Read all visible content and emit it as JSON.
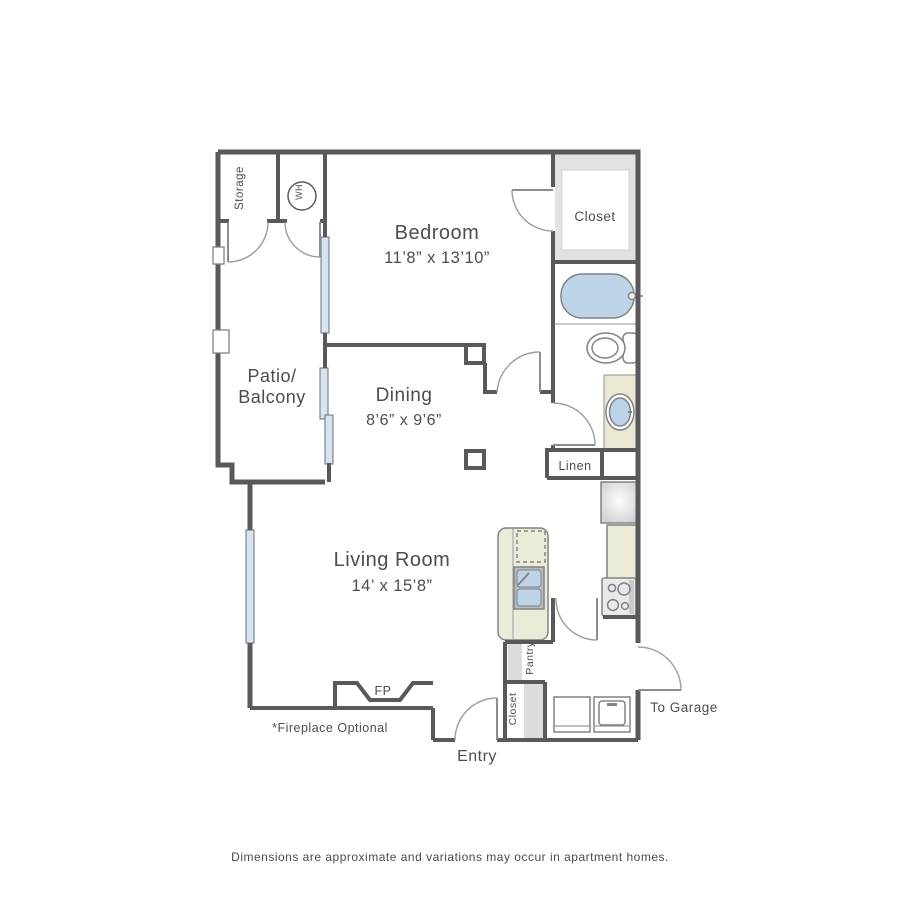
{
  "plan": {
    "rooms": {
      "storage": {
        "label": "Storage"
      },
      "water_heater": {
        "label": "WH"
      },
      "bedroom": {
        "label": "Bedroom",
        "dims": "11’8” x 13’10”"
      },
      "bedroom_closet": {
        "label": "Closet"
      },
      "patio": {
        "label_line1": "Patio/",
        "label_line2": "Balcony"
      },
      "dining": {
        "label": "Dining",
        "dims": "8’6” x 9’6”"
      },
      "linen": {
        "label": "Linen"
      },
      "living": {
        "label": "Living Room",
        "dims": "14’ x 15’8”"
      },
      "pantry": {
        "label": "Pantry"
      },
      "entry_closet": {
        "label": "Closet"
      },
      "entry": {
        "label": "Entry"
      },
      "garage": {
        "label": "To Garage"
      }
    },
    "fireplace": {
      "label": "FP",
      "note": "*Fireplace Optional"
    },
    "footer": {
      "disclaimer": "Dimensions are approximate and variations may occur in apartment homes."
    },
    "colors": {
      "wall": "#58595B",
      "window_fill": "#D6E4F1",
      "fixture_blue": "#BDD3E7",
      "cabinet_cream": "#ECEBD7",
      "shelf_gray": "#E2E2E3",
      "door_line": "#9B9DA0",
      "text": "#4D4D4F"
    }
  }
}
